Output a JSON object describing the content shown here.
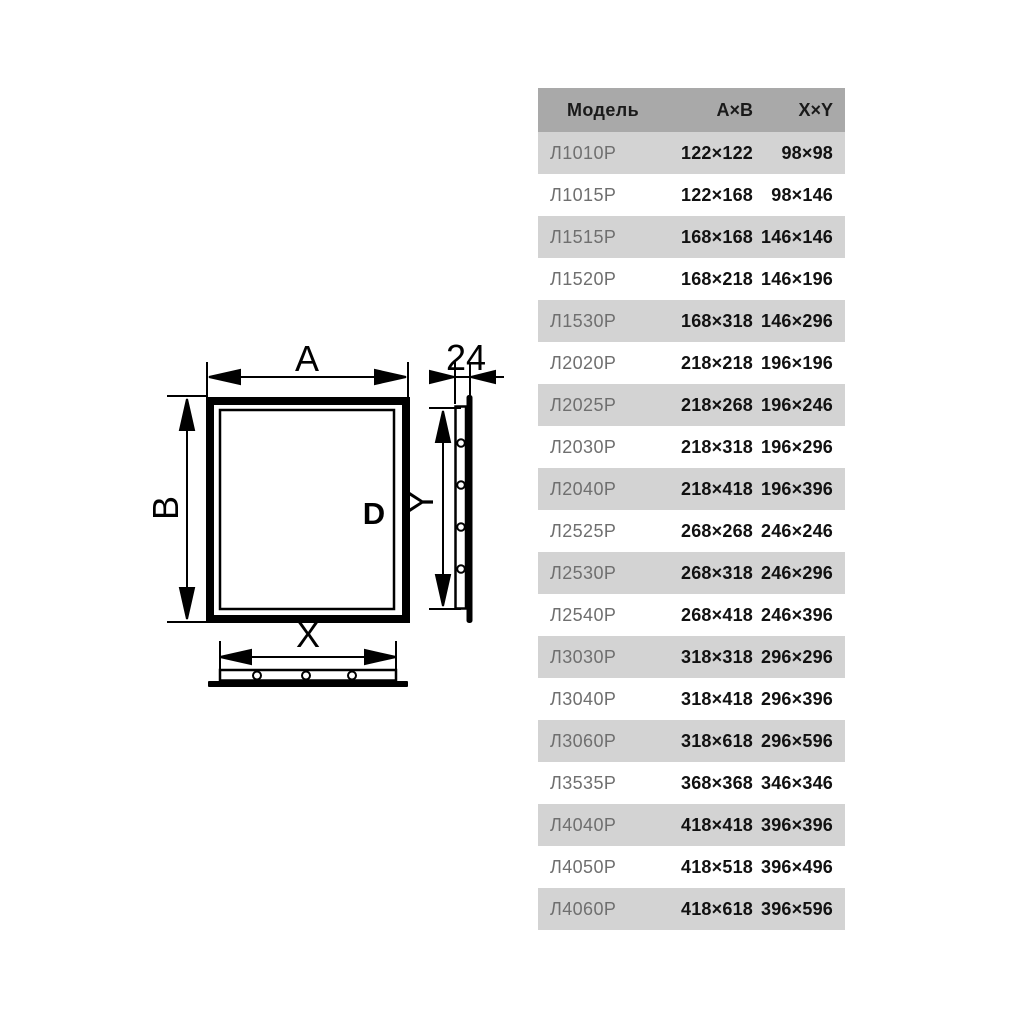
{
  "diagram": {
    "labels": {
      "width": "A",
      "height": "B",
      "inner_width": "X",
      "inner_height": "Y",
      "depth": "24",
      "handle": "D"
    }
  },
  "table": {
    "headers": {
      "model": "Модель",
      "ab": "A×B",
      "xy": "X×Y"
    },
    "rows": [
      {
        "model": "Л1010Р",
        "ab": "122×122",
        "xy": "98×98"
      },
      {
        "model": "Л1015Р",
        "ab": "122×168",
        "xy": "98×146"
      },
      {
        "model": "Л1515Р",
        "ab": "168×168",
        "xy": "146×146"
      },
      {
        "model": "Л1520Р",
        "ab": "168×218",
        "xy": "146×196"
      },
      {
        "model": "Л1530Р",
        "ab": "168×318",
        "xy": "146×296"
      },
      {
        "model": "Л2020Р",
        "ab": "218×218",
        "xy": "196×196"
      },
      {
        "model": "Л2025Р",
        "ab": "218×268",
        "xy": "196×246"
      },
      {
        "model": "Л2030Р",
        "ab": "218×318",
        "xy": "196×296"
      },
      {
        "model": "Л2040Р",
        "ab": "218×418",
        "xy": "196×396"
      },
      {
        "model": "Л2525Р",
        "ab": "268×268",
        "xy": "246×246"
      },
      {
        "model": "Л2530Р",
        "ab": "268×318",
        "xy": "246×296"
      },
      {
        "model": "Л2540Р",
        "ab": "268×418",
        "xy": "246×396"
      },
      {
        "model": "Л3030Р",
        "ab": "318×318",
        "xy": "296×296"
      },
      {
        "model": "Л3040Р",
        "ab": "318×418",
        "xy": "296×396"
      },
      {
        "model": "Л3060Р",
        "ab": "318×618",
        "xy": "296×596"
      },
      {
        "model": "Л3535Р",
        "ab": "368×368",
        "xy": "346×346"
      },
      {
        "model": "Л4040Р",
        "ab": "418×418",
        "xy": "396×396"
      },
      {
        "model": "Л4050Р",
        "ab": "418×518",
        "xy": "396×496"
      },
      {
        "model": "Л4060Р",
        "ab": "418×618",
        "xy": "396×596"
      }
    ]
  },
  "colors": {
    "page_bg": "#ffffff",
    "header_bg": "#a9a9a9",
    "row_alt_bg": "#d3d3d3",
    "row_bg": "#ffffff",
    "model_text": "#6f6f6f",
    "value_text": "#111111",
    "line_color": "#000000"
  }
}
